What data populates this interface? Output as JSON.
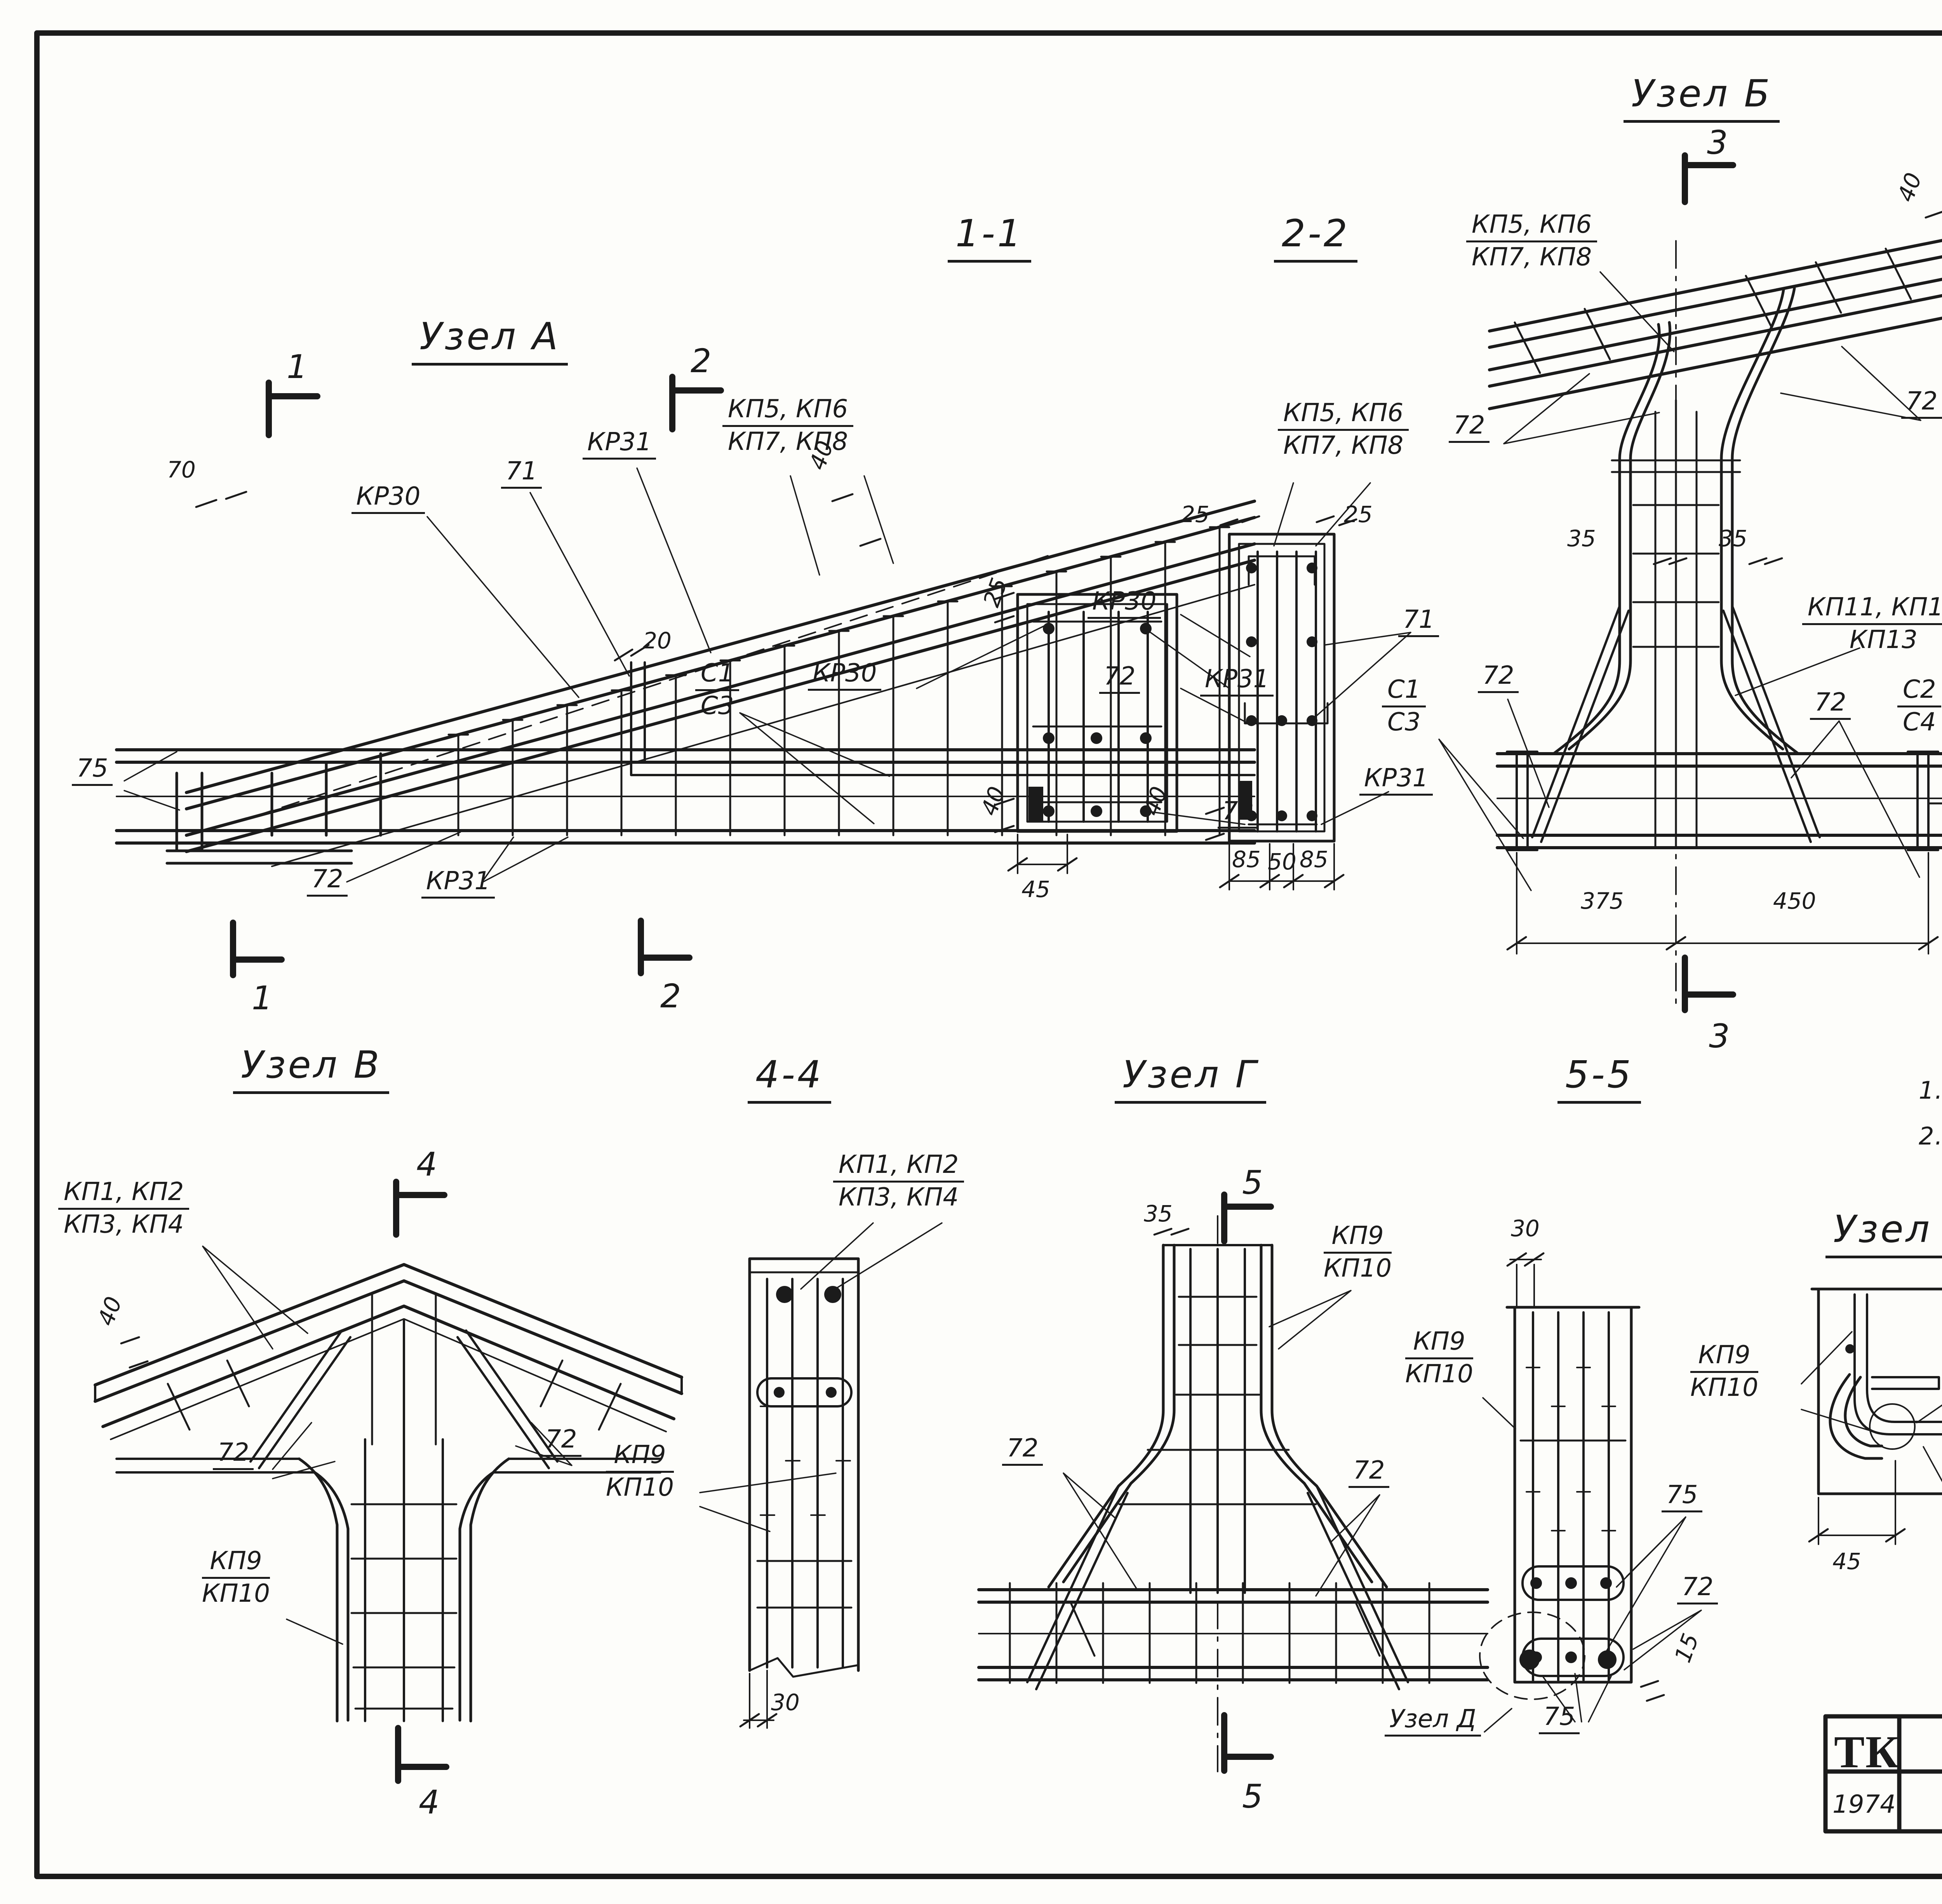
{
  "sheet": {
    "corner_number": "26",
    "doc_number": "13221-01",
    "stamp_number": "26"
  },
  "title_block": {
    "logo": "ТК",
    "project": "Фермы   пролетом   18 м",
    "series_label": "Серия",
    "series_value": "1.463-10",
    "year": "1974",
    "sheet_title": "Арматурные  узлы  А, Б, В, Г, Д.",
    "issue_label": "Выпуск",
    "issue_value": "1",
    "sheet_label": "Лист",
    "sheet_value": "25"
  },
  "notes": {
    "n1": "1.  Арматурные   чертежи  даны  на  листах 23и24",
    "n2": "2.  Разбивка  стержней  в  нижнем  поясе",
    "n3": "дана  для  фермы  ФТ18-6АШв."
  },
  "views": {
    "uzel_a": {
      "title": "Узел А",
      "sec1": "1",
      "sec2": "2",
      "d70": "70",
      "kr30": "КР30",
      "n71": "71",
      "kr31": "КР31",
      "kp_a": "КП5, КП6",
      "kp_b": "КП7, КП8",
      "d40": "40",
      "d20": "20",
      "c1": "С1",
      "c3": "С3",
      "d75": "75",
      "n72": "72",
      "kr31b": "КР31"
    },
    "s11": {
      "title": "1-1",
      "d25": "25",
      "kr30": "КР30",
      "kr31": "КР31",
      "n72": "72",
      "d40": "40",
      "d45": "45"
    },
    "s22": {
      "title": "2-2",
      "kp_a": "КП5, КП6",
      "kp_b": "КП7, КП8",
      "d25l": "25",
      "d25r": "25",
      "kr30": "КР30",
      "n72": "72",
      "n71": "71",
      "kr31": "КР31",
      "d40": "40",
      "d85a": "85",
      "d50": "50",
      "d85b": "85"
    },
    "uzel_b": {
      "title": "Узел Б",
      "sec3": "3",
      "kp_a": "КП5, КП6",
      "kp_b": "КП7, КП8",
      "d40": "40",
      "n72a": "72",
      "n72b": "72",
      "d35a": "35",
      "d35b": "35",
      "kp11_a": "КП11, КП12",
      "kp11_b": "КП13",
      "c1": "С1",
      "c3": "С3",
      "n72c": "72",
      "n72d": "72",
      "c2": "С2",
      "c4": "С4",
      "d375": "375",
      "d450": "450",
      "d15": "15"
    },
    "s33ft": {
      "title": "3-3(ФТ18-1)",
      "n72": "72",
      "kp_a": "КП5, КП6",
      "kp_b": "КП7, КП8",
      "kp11": "КП11",
      "kp12": "КП12",
      "kp13": "КП13",
      "d55": "55",
      "d15": "15"
    },
    "s33": {
      "title": "3-3",
      "n72a": "72",
      "n72b": "72",
      "d15": "15"
    },
    "uzel_v": {
      "title": "Узел В",
      "sec4": "4",
      "kp_a": "КП1, КП2",
      "kp_b": "КП3, КП4",
      "d40": "40",
      "n72a": "72",
      "n72b": "72",
      "kp9": "КП9",
      "kp10": "КП10"
    },
    "s44": {
      "title": "4-4",
      "kp_a": "КП1, КП2",
      "kp_b": "КП3, КП4",
      "kp9": "КП9",
      "kp10": "КП10",
      "d30": "30"
    },
    "uzel_g": {
      "title": "Узел Г",
      "sec5": "5",
      "d35": "35",
      "kp9": "КП9",
      "kp10": "КП10",
      "n72a": "72",
      "n72b": "72",
      "uzel_d_ref": "Узел Д",
      "d75": "75"
    },
    "s55": {
      "title": "5-5",
      "d30": "30",
      "kp9": "КП9",
      "kp10": "КП10",
      "n75": "75",
      "n72": "72",
      "d15": "15"
    },
    "uzel_d": {
      "title": "Узел Д",
      "kp9": "КП9",
      "kp10": "КП10",
      "n75": "75",
      "d40": "40",
      "d45": "45",
      "n72": "72"
    }
  }
}
